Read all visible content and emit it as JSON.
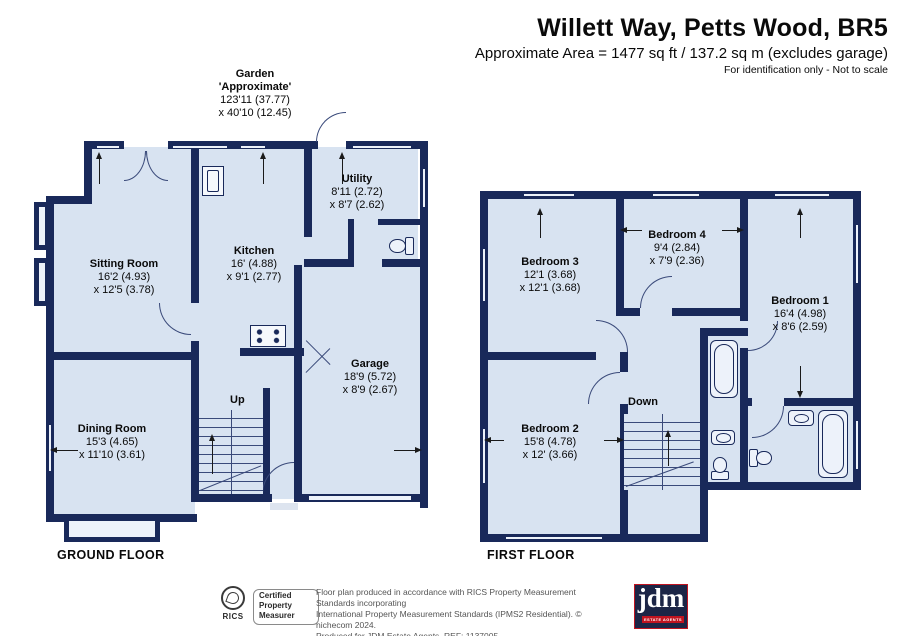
{
  "header": {
    "title": "Willett Way, Petts Wood, BR5",
    "subtitle": "Approximate Area = 1477 sq ft / 137.2 sq m (excludes garage)",
    "note": "For identification only - Not to scale"
  },
  "garden": {
    "title": "Garden",
    "subtitle": "'Approximate'",
    "dim1": "123'11 (37.77)",
    "dim2": "x 40'10 (12.45)"
  },
  "floors": {
    "ground": {
      "label": "GROUND FLOOR",
      "stairs": "Up",
      "rooms": [
        {
          "name": "Sitting Room",
          "dim1": "16'2 (4.93)",
          "dim2": "x 12'5 (3.78)"
        },
        {
          "name": "Kitchen",
          "dim1": "16' (4.88)",
          "dim2": "x 9'1 (2.77)"
        },
        {
          "name": "Utility",
          "dim1": "8'11 (2.72)",
          "dim2": "x 8'7 (2.62)"
        },
        {
          "name": "Dining Room",
          "dim1": "15'3 (4.65)",
          "dim2": "x 11'10 (3.61)"
        },
        {
          "name": "Garage",
          "dim1": "18'9 (5.72)",
          "dim2": "x 8'9 (2.67)"
        }
      ]
    },
    "first": {
      "label": "FIRST FLOOR",
      "stairs": "Down",
      "rooms": [
        {
          "name": "Bedroom 3",
          "dim1": "12'1 (3.68)",
          "dim2": "x 12'1 (3.68)"
        },
        {
          "name": "Bedroom 4",
          "dim1": "9'4 (2.84)",
          "dim2": "x 7'9 (2.36)"
        },
        {
          "name": "Bedroom 1",
          "dim1": "16'4 (4.98)",
          "dim2": "x 8'6 (2.59)"
        },
        {
          "name": "Bedroom 2",
          "dim1": "15'8 (4.78)",
          "dim2": "x 12' (3.66)"
        }
      ]
    }
  },
  "footer": {
    "rics": {
      "brand": "RICS",
      "line1": "Certified",
      "line2": "Property",
      "line3": "Measurer"
    },
    "disclaimer_line1": "Floor plan produced in accordance with RICS Property Measurement Standards incorporating",
    "disclaimer_line2": "International Property Measurement Standards (IPMS2 Residential).  © nichecom 2024.",
    "disclaimer_line3": "Produced for JDM Estate Agents.   REF: 1137005",
    "jdm": {
      "brand": "jdm",
      "tagline": "ESTATE AGENTS"
    }
  },
  "colors": {
    "wall": "#19295a",
    "room_fill": "#d8e3f1",
    "window_fill": "#edf2fa",
    "jdm_red": "#c01420"
  }
}
